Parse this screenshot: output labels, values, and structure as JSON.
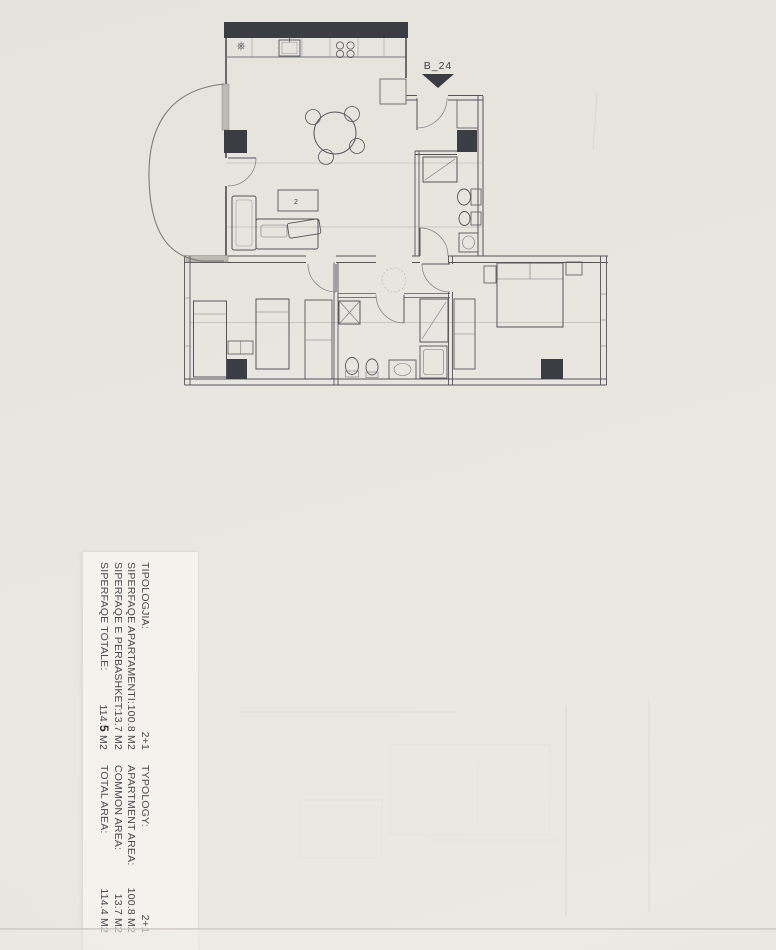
{
  "colors": {
    "paper": "#e9e6e0",
    "strip": "#f4f2ed",
    "ink": "#55545b",
    "wall": "#3a3d43",
    "faint": "#a9a59c",
    "txt": "#4b4a4e"
  },
  "plan": {
    "unit_label": "B_24",
    "table_label": "2"
  },
  "info_panel": {
    "albanian": {
      "rows": [
        {
          "label": "TIPOLOGJIA:",
          "value": "2+1"
        },
        {
          "label": "SIPERFAQE APARTAMENTI:",
          "value": "100.8 M2"
        },
        {
          "label": "SIPERFAQE E PERBASHKET:",
          "value": "13.7 M2"
        },
        {
          "label": "SIPERFAQE TOTALE:",
          "value_pre": "114.",
          "value_bold": "5",
          "value_post": " M2"
        }
      ]
    },
    "english": {
      "rows": [
        {
          "label": "TYPOLOGY:",
          "value": "2+1"
        },
        {
          "label": "APARTMENT AREA:",
          "value": "100.8 M2"
        },
        {
          "label": "COMMON AREA:",
          "value": "13.7 M2"
        },
        {
          "label": "TOTAL AREA:",
          "value": "114.4 M2"
        }
      ]
    }
  }
}
